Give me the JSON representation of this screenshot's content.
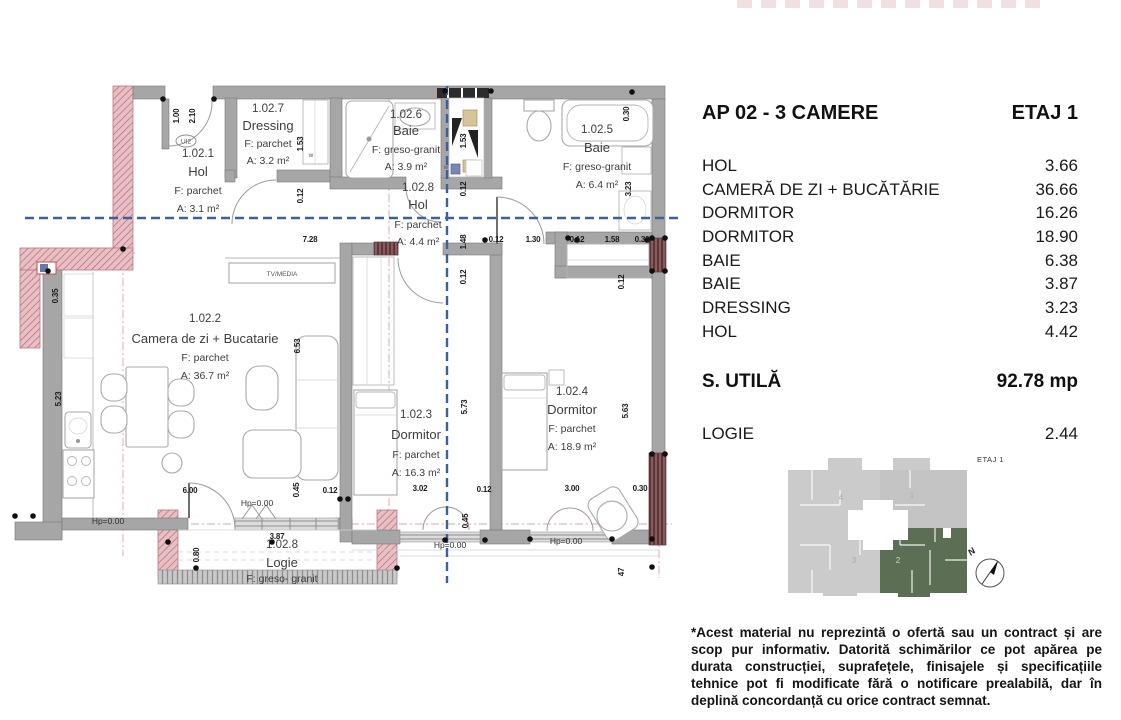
{
  "header": {
    "title_left": "AP 02 - 3 CAMERE",
    "title_right": "ETAJ 1"
  },
  "area_table": {
    "rows": [
      {
        "label": "HOL",
        "value": "3.66"
      },
      {
        "label": "CAMERĂ DE ZI + BUCĂTĂRIE",
        "value": "36.66"
      },
      {
        "label": "DORMITOR",
        "value": "16.26"
      },
      {
        "label": "DORMITOR",
        "value": "18.90"
      },
      {
        "label": "BAIE",
        "value": "6.38"
      },
      {
        "label": "BAIE",
        "value": "3.87"
      },
      {
        "label": "DRESSING",
        "value": "3.23"
      },
      {
        "label": "HOL",
        "value": "4.42"
      }
    ]
  },
  "summary": {
    "label": "S. UTILĂ",
    "value": "92.78 mp"
  },
  "logie_row": {
    "label": "LOGIE",
    "value": "2.44"
  },
  "keyplan": {
    "floor_label": "ETAJ 1",
    "north_label": "N",
    "highlighted_unit": "2",
    "units": {
      "u1": "1",
      "u2": "2",
      "u3": "3",
      "u4": "4"
    },
    "highlight_color": "#5c6e54"
  },
  "disclaimer": "*Acest material nu reprezintă o ofertă sau un contract și are scop pur informativ. Datorită schimărilor ce pot apărea pe durata construcției, suprafețele, finisajele și specificațiile tehnice pot fi modificate fără o notificare prealabilă, dar în deplină concordanță cu orice contract semnat.",
  "plan": {
    "rooms": [
      {
        "id": "1.02.1",
        "name": "Hol",
        "floor": "F: parchet",
        "area": "A: 3.1 m²"
      },
      {
        "id": "1.02.7",
        "name": "Dressing",
        "floor": "F: parchet",
        "area": "A: 3.2 m²"
      },
      {
        "id": "1.02.6",
        "name": "Baie",
        "floor": "F: greso-granit",
        "area": "A: 3.9 m²"
      },
      {
        "id": "1.02.5",
        "name": "Baie",
        "floor": "F: greso-granit",
        "area": "A: 6.4 m²"
      },
      {
        "id": "1.02.8",
        "name": "Hol",
        "floor": "F: parchet",
        "area": "A: 4.4 m²"
      },
      {
        "id": "1.02.2",
        "name": "Camera de zi + Bucatarie",
        "floor": "F: parchet",
        "area": "A: 36.7 m²"
      },
      {
        "id": "1.02.3",
        "name": "Dormitor",
        "floor": "F: parchet",
        "area": "A: 16.3 m²"
      },
      {
        "id": "1.02.4",
        "name": "Dormitor",
        "floor": "F: parchet",
        "area": "A: 18.9 m²"
      },
      {
        "id": "1.02.8",
        "name": "Logie",
        "floor": "F: greso- granit",
        "area": ""
      }
    ],
    "dims": [
      {
        "t": "7.28"
      },
      {
        "t": "0.12"
      },
      {
        "t": "1.30"
      },
      {
        "t": "0.12"
      },
      {
        "t": "1.58"
      },
      {
        "t": "0.30"
      },
      {
        "t": "1.00"
      },
      {
        "t": "2.10"
      },
      {
        "t": "1.53"
      },
      {
        "t": "0.12"
      },
      {
        "t": "1.53"
      },
      {
        "t": "0.12"
      },
      {
        "t": "1.48"
      },
      {
        "t": "0.12"
      },
      {
        "t": "0.30"
      },
      {
        "t": "3.23"
      },
      {
        "t": "0.35"
      },
      {
        "t": "5.23"
      },
      {
        "t": "6.53"
      },
      {
        "t": "5.73"
      },
      {
        "t": "5.63"
      },
      {
        "t": "6.00"
      },
      {
        "t": "0.45"
      },
      {
        "t": "0.12"
      },
      {
        "t": "3.02"
      },
      {
        "t": "0.12"
      },
      {
        "t": "3.00"
      },
      {
        "t": "0.30"
      },
      {
        "t": "3.87"
      },
      {
        "t": "0.80"
      },
      {
        "t": "0.45"
      },
      {
        "t": "47"
      },
      {
        "t": "0.12"
      }
    ],
    "annotations": {
      "tv_media": "TV/MEDIA",
      "entry_door": "UI2",
      "w_marker": "w",
      "hp": "Hp=0.00"
    }
  }
}
